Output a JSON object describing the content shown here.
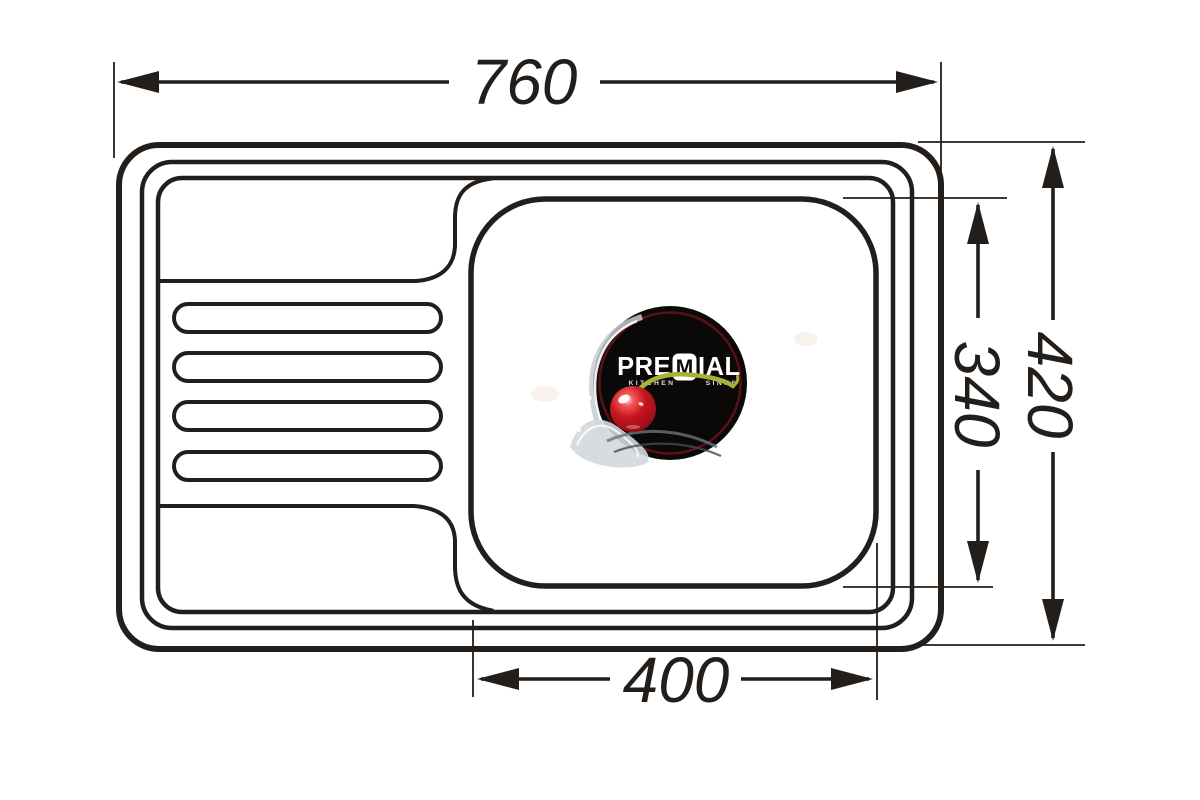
{
  "drawing": {
    "dimensions": {
      "overall_width": "760",
      "overall_depth": "420",
      "bowl_depth": "340",
      "bowl_width": "400"
    },
    "logo": {
      "brand_pre": "PRE",
      "brand_m": "M",
      "brand_ial": "IAL",
      "tagline_kitchen": "KITCHEN",
      "tagline_sinks": "SINKS"
    },
    "colors": {
      "line": "#241e1a",
      "logo_background": "#0b0908",
      "logo_ring": "#5a1016",
      "cherry_red": "#c9151f",
      "stem_green": "#a9b236",
      "splash_gray": "#c6ccd4"
    }
  }
}
